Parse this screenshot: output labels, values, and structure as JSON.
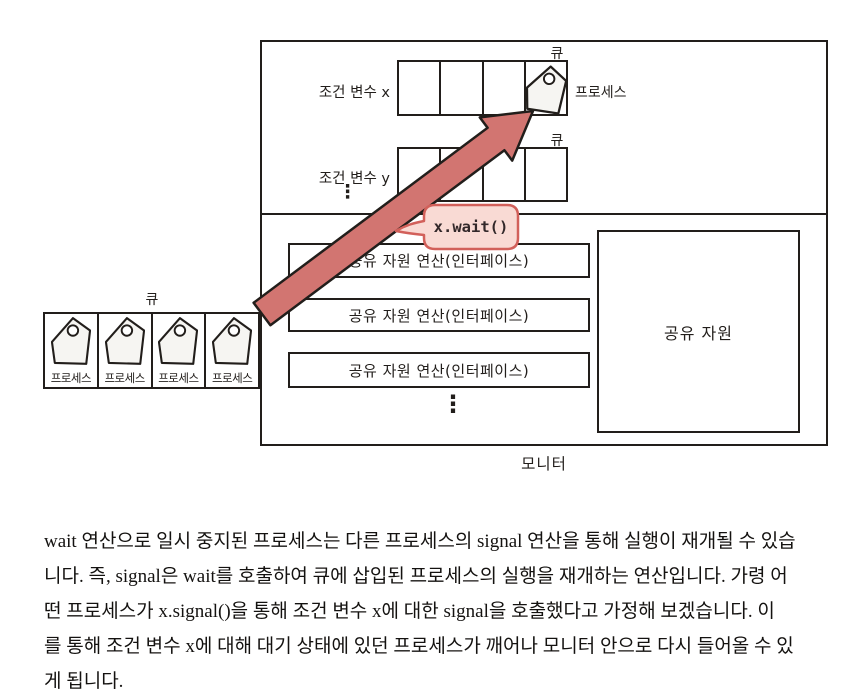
{
  "diagram": {
    "monitor_label": "모니터",
    "shared_resource_label": "공유 자원",
    "queue_label": "큐",
    "condition_x_label": "조건 변수 x",
    "condition_y_label": "조건 변수 y",
    "process_label": "프로세스",
    "wait_bubble_label": "x.wait()",
    "operation_rows": [
      "공유 자원 연산(인터페이스)",
      "공유 자원 연산(인터페이스)",
      "공유 자원 연산(인터페이스)"
    ],
    "external_processes": [
      "프로세스",
      "프로세스",
      "프로세스",
      "프로세스"
    ],
    "ellipsis": "⋮",
    "colors": {
      "ink": "#221e1b",
      "arrow_fill": "#d27571",
      "bubble_fill": "#f9dad4",
      "bubble_border": "#d2605a",
      "tag_fill": "#f6f5f2"
    }
  },
  "paragraph": {
    "lines": [
      "wait 연산으로 일시 중지된 프로세스는 다른 프로세스의 signal 연산을 통해 실행이 재개될 수 있습",
      "니다. 즉, signal은 wait를 호출하여 큐에 삽입된 프로세스의 실행을 재개하는 연산입니다. 가령 어",
      "떤 프로세스가 x.signal()을 통해 조건 변수 x에 대한 signal을 호출했다고 가정해 보겠습니다. 이",
      "를 통해 조건 변수 x에 대해 대기 상태에 있던 프로세스가 깨어나 모니터 안으로 다시 들어올 수 있",
      "게 됩니다."
    ]
  }
}
